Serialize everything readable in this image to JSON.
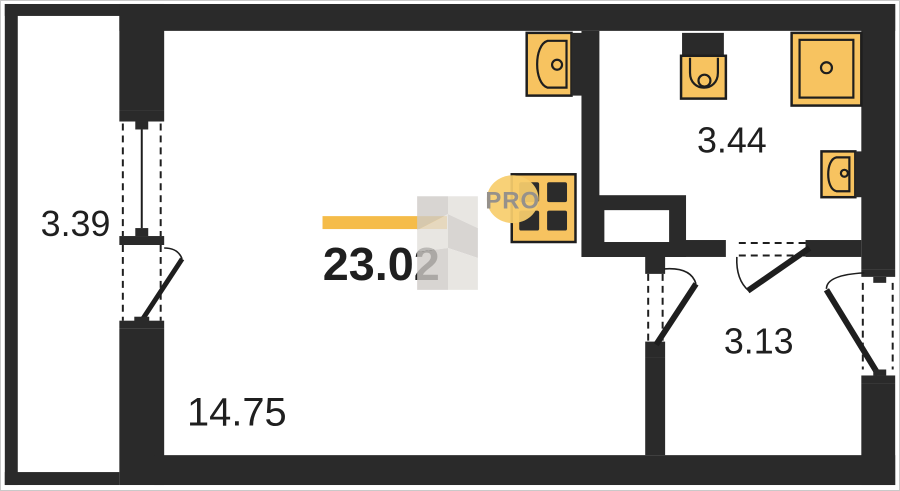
{
  "areas": {
    "balcony": "3.39",
    "total": "23.02",
    "living": "14.75",
    "bathroom": "3.44",
    "hallway": "3.13"
  },
  "watermark": {
    "pro": "PRO"
  },
  "colors": {
    "wall": "#2a2a2a",
    "fixture": "#f7c360",
    "highlight_bar": "#f5bc49",
    "label_text": "#1f1f1f",
    "watermark_gray_light": "#e3e0dc",
    "watermark_gray_mid": "#cfcbc7",
    "pro_circle": "#f8ce6d",
    "pro_text": "#96918b"
  }
}
